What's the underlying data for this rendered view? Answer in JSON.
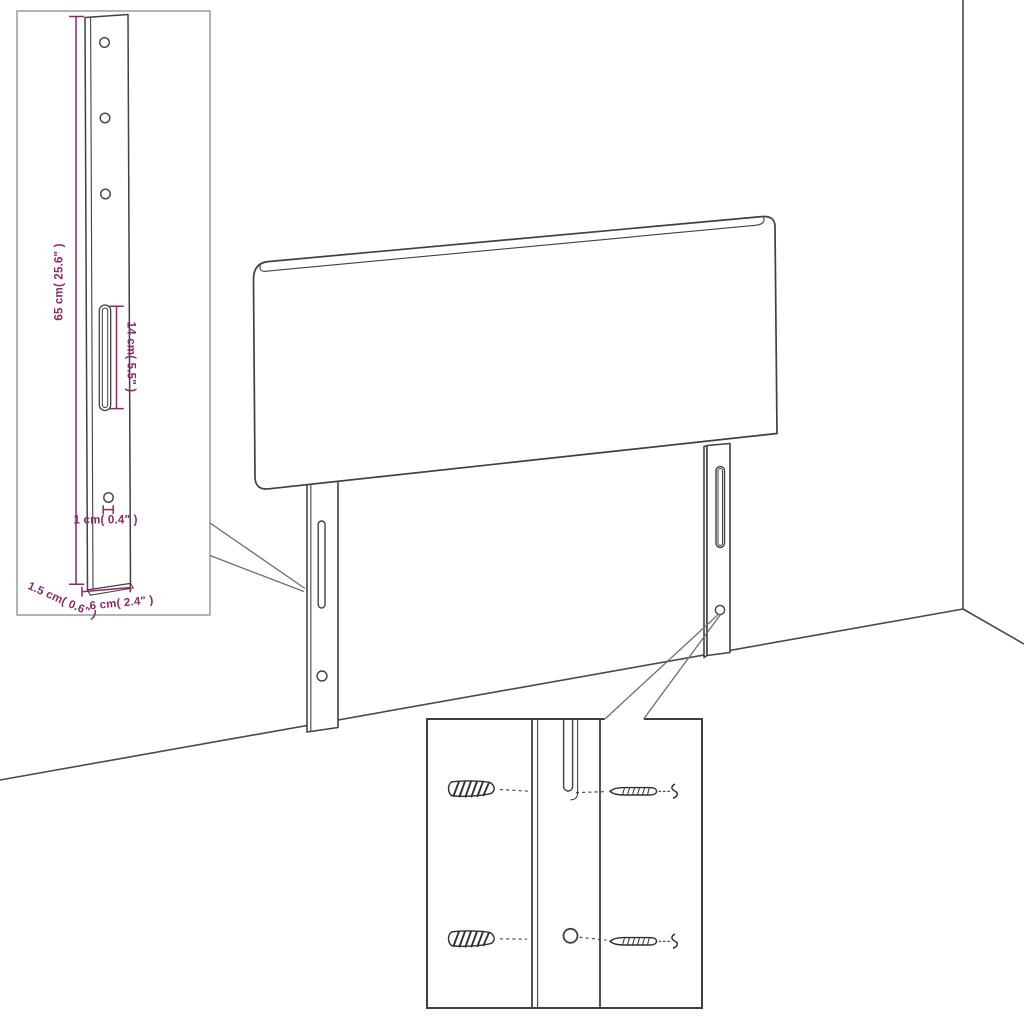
{
  "colors": {
    "background": "#ffffff",
    "outline": "#414141",
    "dimension_accent": "#8b2a64",
    "leader_line": "#6e6e6e",
    "detail_inset_border": "#8c8c8c",
    "mounting_inset_border": "#3f3f3f"
  },
  "leg_detail_inset": {
    "height_label": "65 cm( 25.6\" )",
    "slot_label": "14 cm( 5.5\" )",
    "hole_label": "1 cm( 0.4\" )",
    "thickness_label": "1.5 cm( 0.6\" )",
    "width_label": "6 cm( 2.4\" )"
  }
}
